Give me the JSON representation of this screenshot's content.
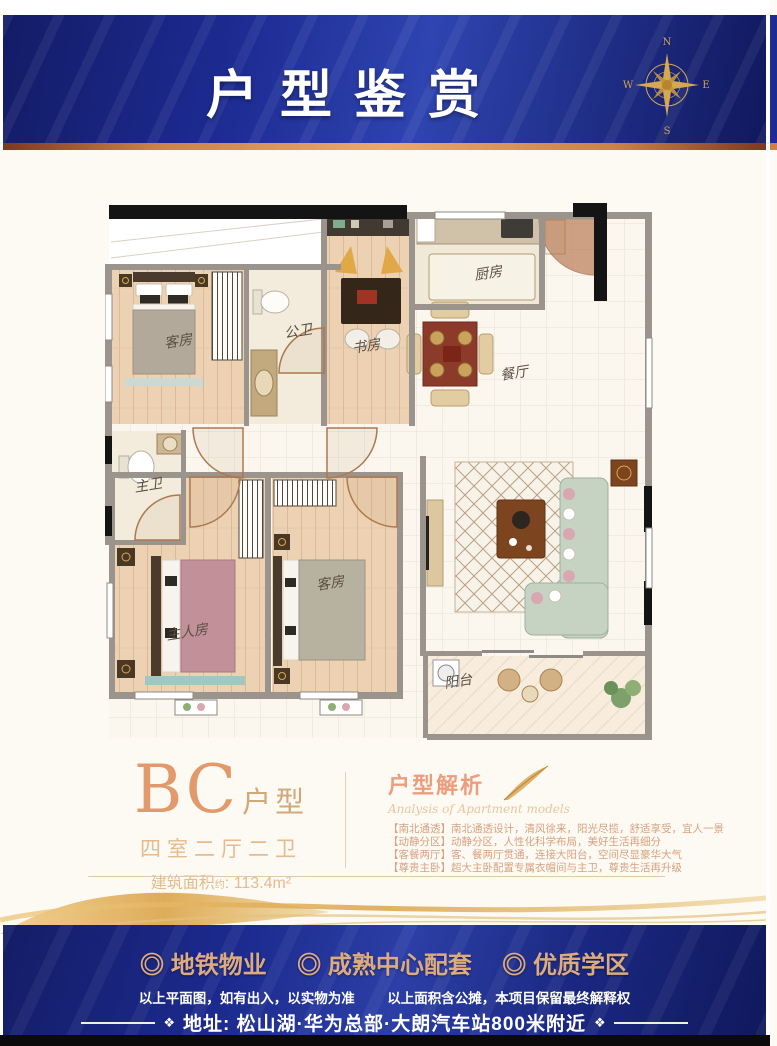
{
  "header": {
    "title": "户型鉴赏"
  },
  "compass": {
    "north": "N",
    "east": "E",
    "south": "S",
    "west": "W"
  },
  "floor_plan": {
    "rooms": {
      "guest_top": "客房",
      "public_bath": "公卫",
      "study": "书房",
      "kitchen": "厨房",
      "dining": "餐厅",
      "master_bath": "主卫",
      "master_bedroom": "主人房",
      "guest_bottom": "客房",
      "balcony": "阳台"
    }
  },
  "unit_info": {
    "code": "BC",
    "suffix": "户型",
    "layout": "四室二厅二卫",
    "area_label": "建筑面积",
    "area_note": "约",
    "area_value": ": 113.4m²"
  },
  "analysis": {
    "title": "户型解析",
    "subtitle": "Analysis of Apartment models",
    "items": [
      "【南北通透】南北通透设计，清风徐来，阳光尽揽，舒适享受，宜人一景",
      "【动静分区】动静分区，人性化科学布局，美好生活再细分",
      "【客餐两厅】客、餐两厅贯通，连接大阳台，空间尽显豪华大气",
      "【尊贵主卧】超大主卧配置专属衣帽间与主卫，尊贵生活再升级"
    ]
  },
  "footer": {
    "highlights": [
      "◎ 地铁物业",
      "◎ 成熟中心配套",
      "◎ 优质学区"
    ],
    "disclaimer_left": "以上平面图，如有出入，以实物为准",
    "disclaimer_right": "以上面积含公摊，本项目保留最终解释权",
    "address": "地址: 松山湖·华为总部·大朗汽车站800米附近",
    "ornament": "❖"
  },
  "colors": {
    "header_blue": "#1d2b92",
    "copper": "#c9824e",
    "gold": "#d9a94f",
    "highlight_tan": "#ddab80"
  }
}
